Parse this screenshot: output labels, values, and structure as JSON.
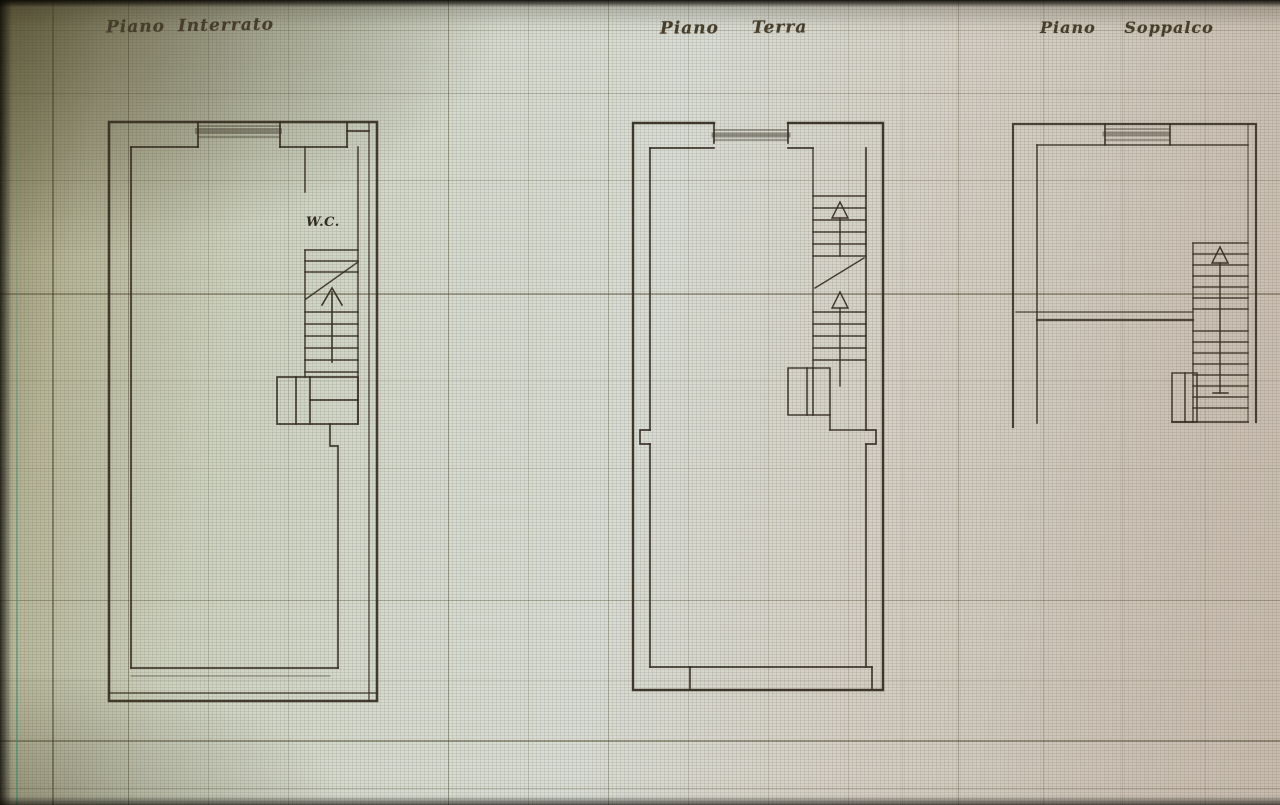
{
  "titles": {
    "left": "Piano Interrato",
    "middle": "Piano Terra",
    "right": "Piano Soppalco"
  },
  "labels": {
    "wc": "W.C."
  },
  "colors": {
    "ink": "#362e22",
    "paper_dark_olive": "#8f8a66",
    "paper_light_green": "#d8dcd4",
    "paper_warm_tan": "#c6bbae",
    "photo_edge": "#0c0a06",
    "margin_line_teal": "#408e76",
    "grid_line": "#4a4228"
  }
}
